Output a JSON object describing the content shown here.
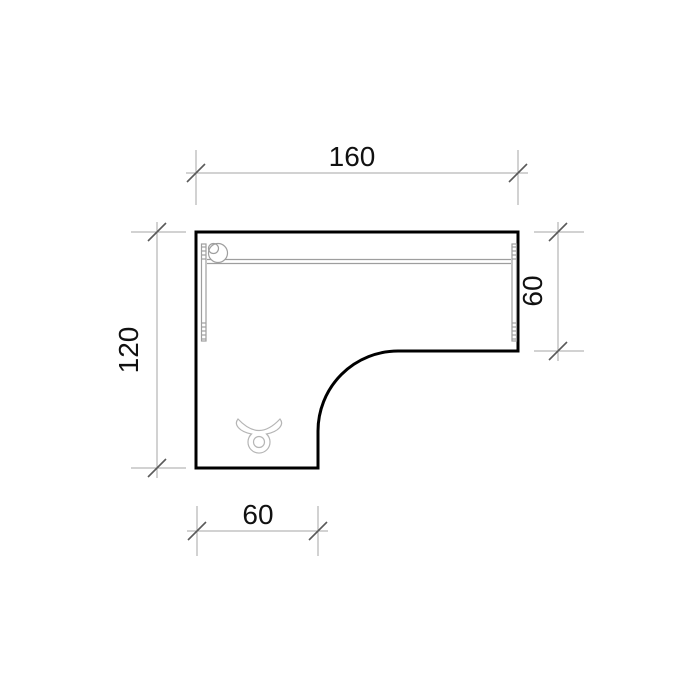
{
  "drawing": {
    "type": "furniture-plan-top-view",
    "dimensions": {
      "top": "160",
      "left": "120",
      "right": "60",
      "bottom": "60"
    },
    "colors": {
      "background": "#ffffff",
      "outline": "#000000",
      "dim_line": "#a6a6a6",
      "tick": "#5a5a5a",
      "text": "#111111",
      "detail": "#9e9e9e",
      "detail_light": "#b5b5b5"
    }
  }
}
